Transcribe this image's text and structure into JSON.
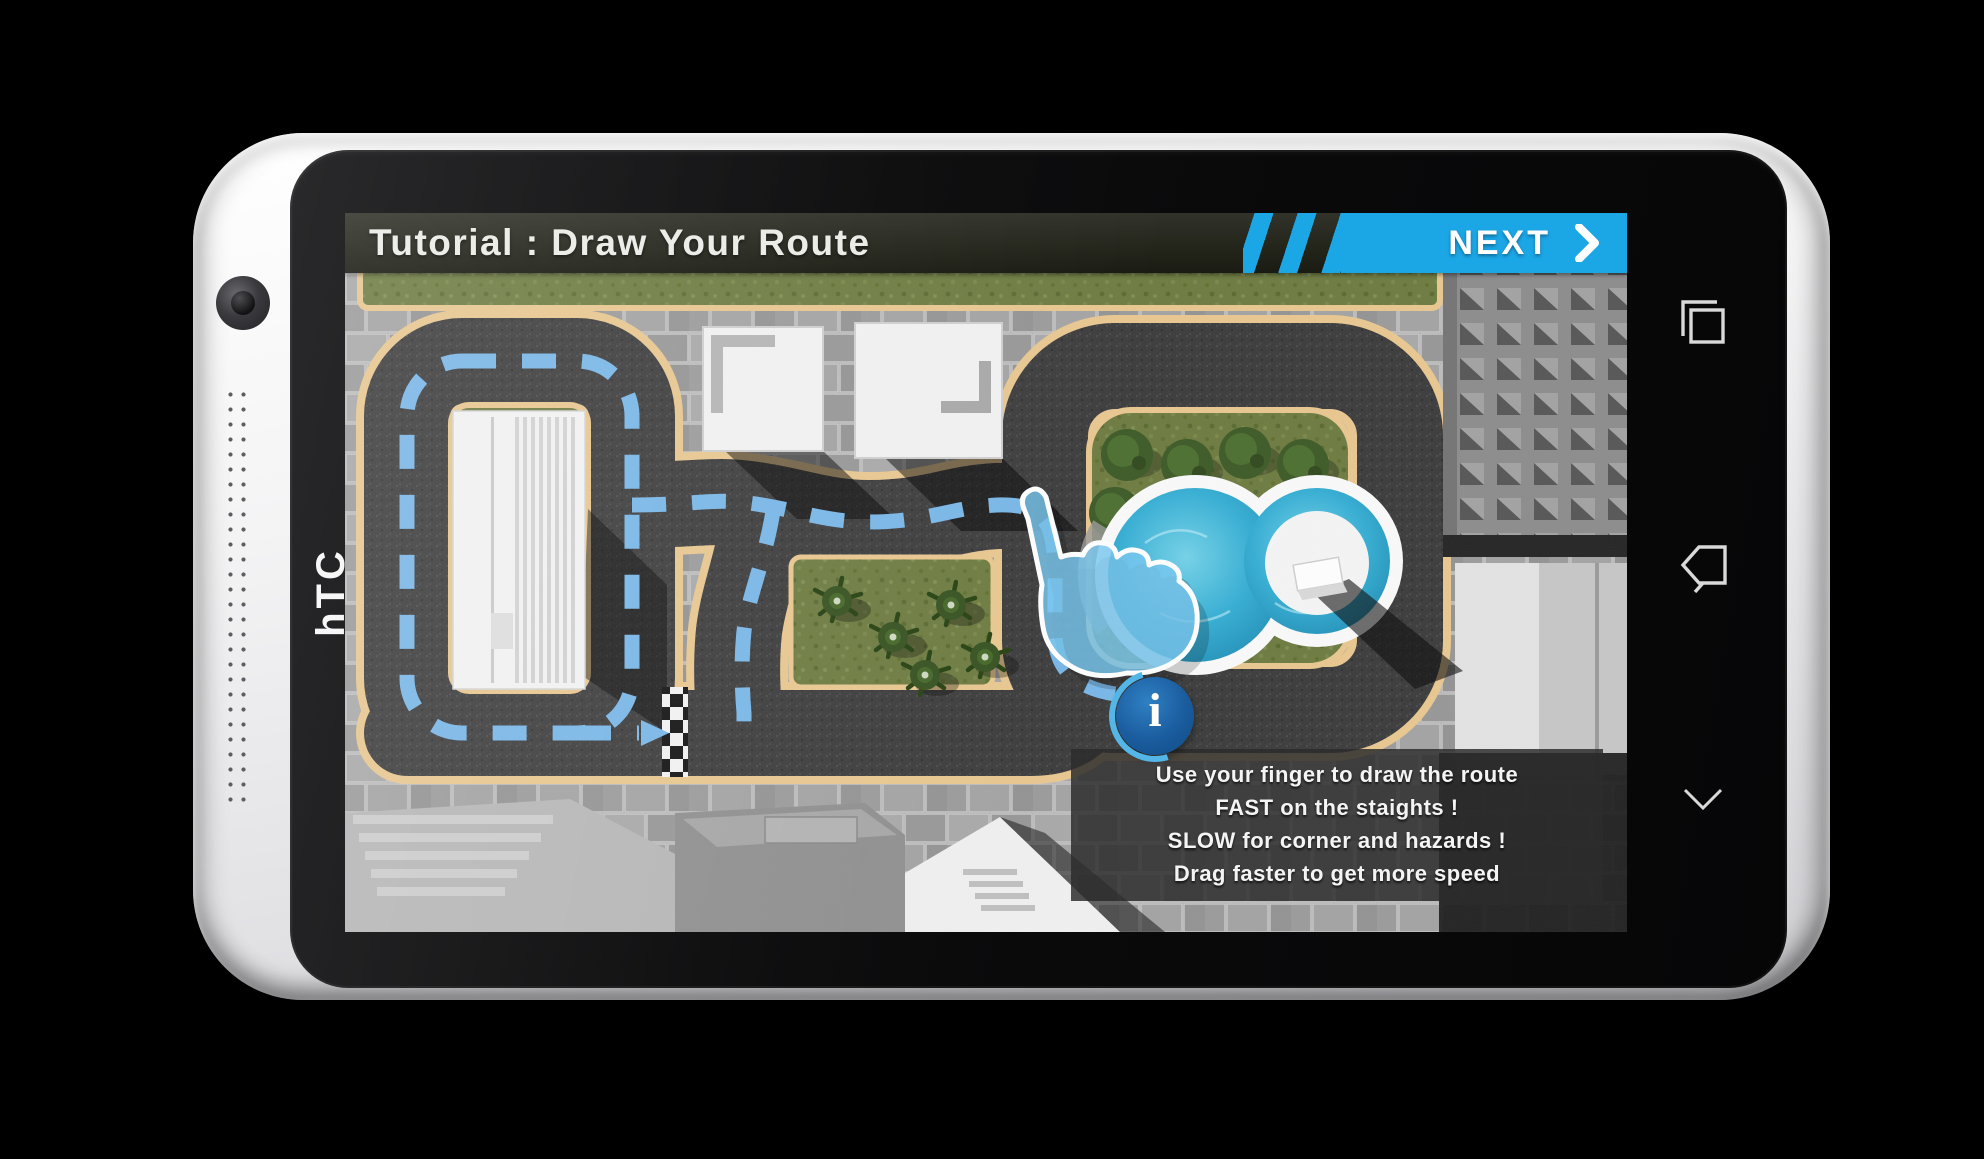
{
  "device": {
    "brand": "hTC",
    "nav_icons": [
      "recent-apps",
      "back",
      "collapse"
    ]
  },
  "app": {
    "title": "Tutorial : Draw Your Route",
    "next_label": "NEXT",
    "info_glyph": "i",
    "tooltip_lines": [
      "Use your finger to draw the route",
      "FAST on the staights !",
      "SLOW for corner and hazards !",
      "Drag faster to get more speed"
    ],
    "colors": {
      "accent_blue": "#1ba6e6",
      "route_blue": "#78b7e8",
      "track_asphalt": "#3b3b3c",
      "track_border_tan": "#e9c78f",
      "grass_green": "#6d7b40",
      "pool_blue": "#35aed4",
      "tooltip_bg": "rgba(44,44,44,0.84)",
      "info_blue": "#1a5c9e"
    }
  }
}
